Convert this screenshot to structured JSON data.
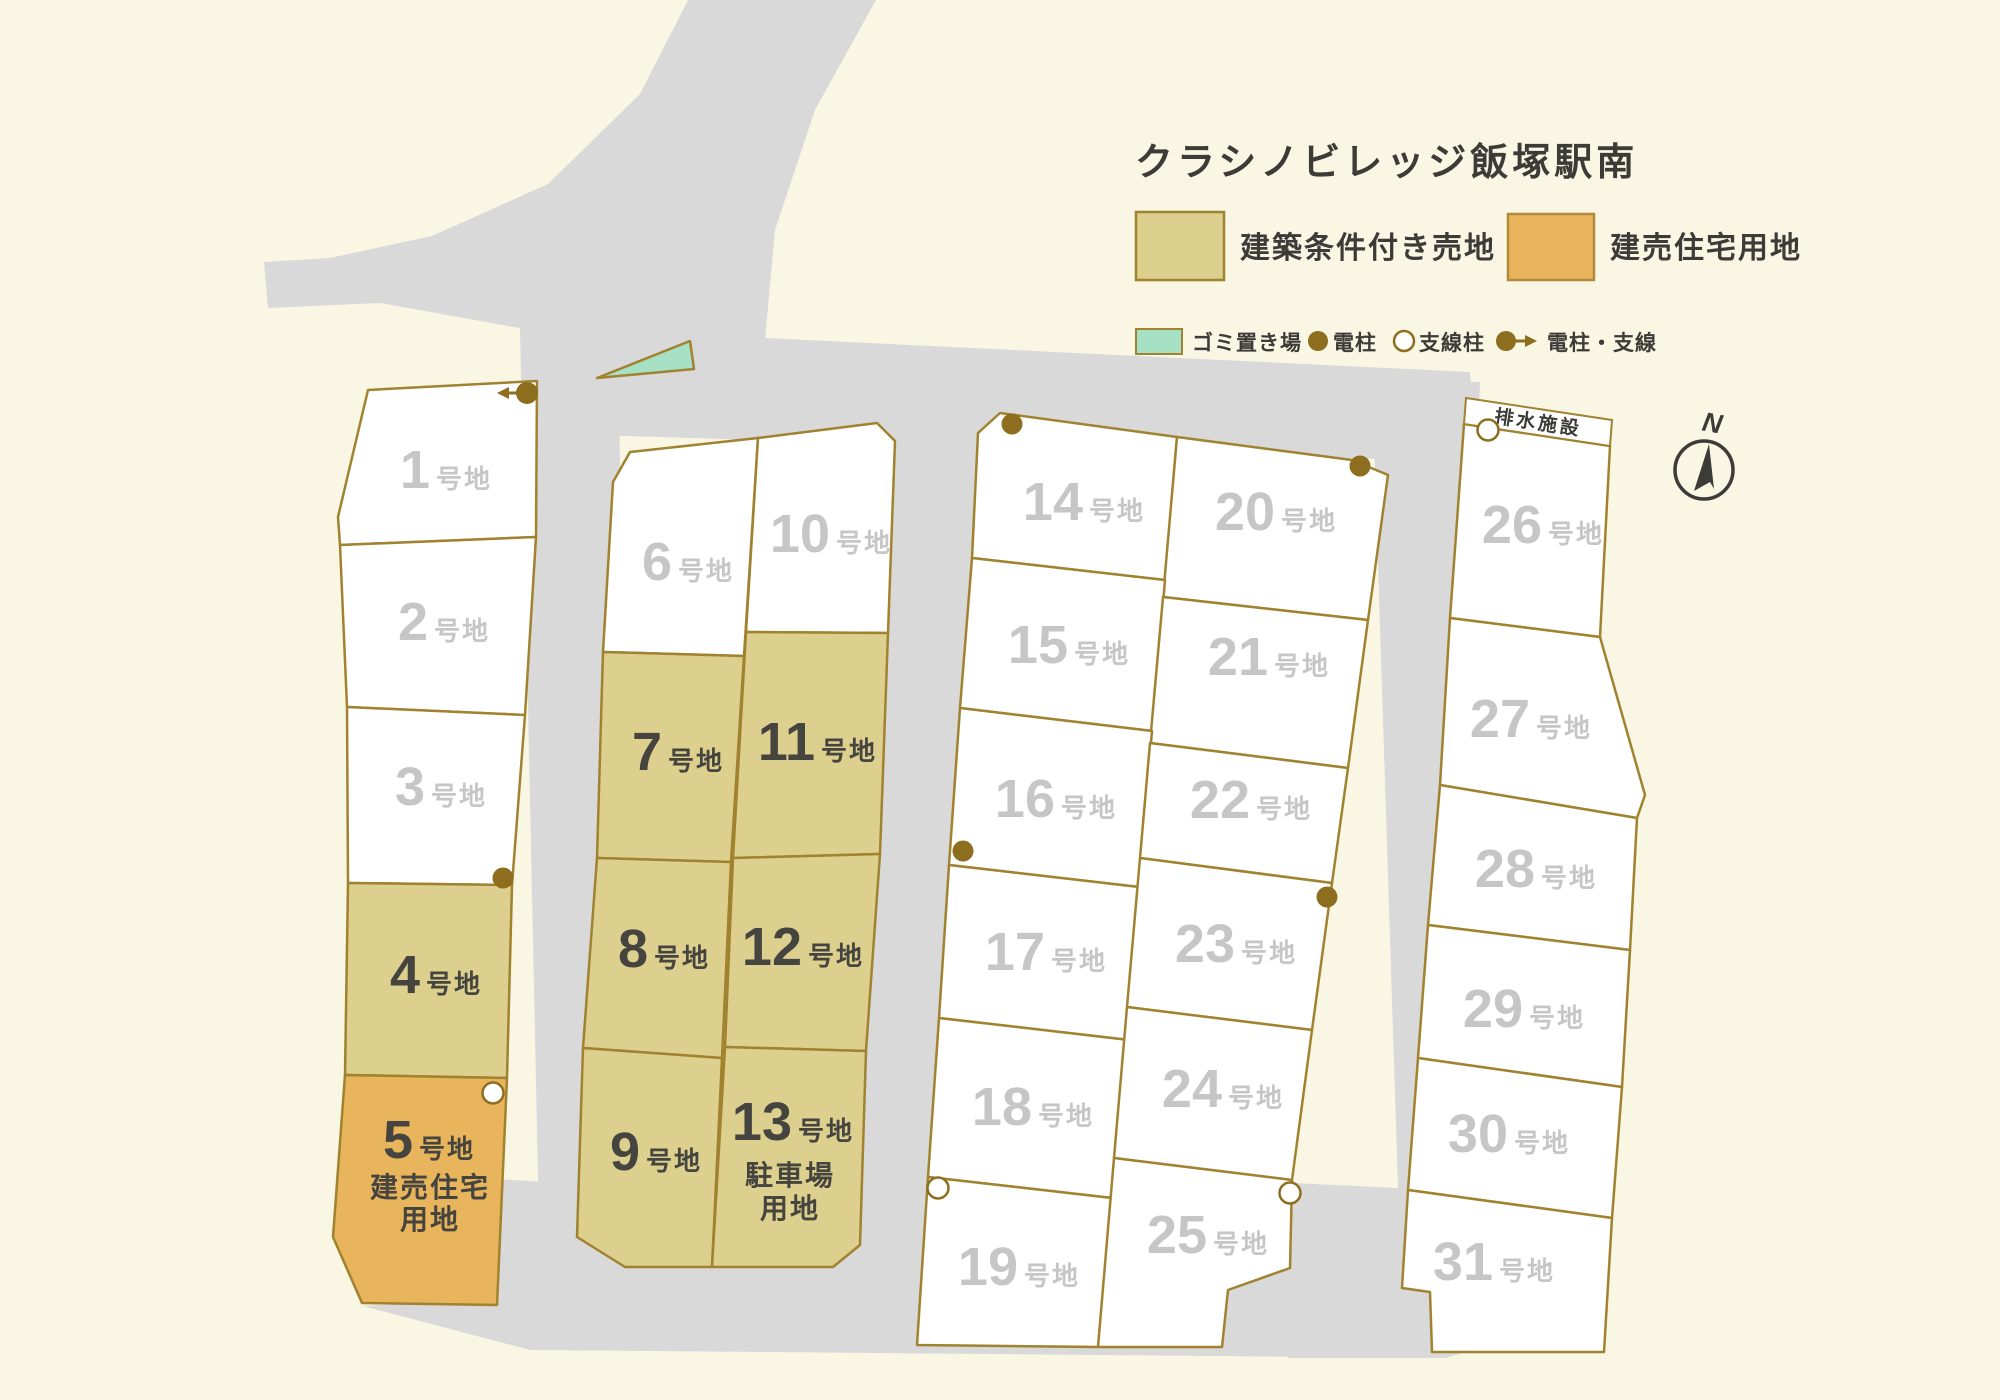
{
  "title": "クラシノビレッジ飯塚駅南",
  "legend": {
    "items": [
      {
        "label": "建築条件付き売地",
        "color": "#ddd08f"
      },
      {
        "label": "建売住宅用地",
        "color": "#e8b55c"
      }
    ],
    "markers": [
      {
        "label": "ゴミ置き場",
        "color": "#a6e1c6"
      },
      {
        "label": "電柱",
        "color": "#8d6e1f"
      },
      {
        "label": "支線柱",
        "color": "#ffffff"
      },
      {
        "label": "電柱・支線",
        "color": "#8d6e1f"
      }
    ]
  },
  "compass": {
    "north_label": "N"
  },
  "annotations": {
    "drainage": "排水施設"
  },
  "colors": {
    "background": "#faf6e4",
    "road": "#d9d9da",
    "border": "#a0822f",
    "pole": "#8d6e1f",
    "label_gray": "#c6c6c6",
    "label_dark": "#45443f"
  },
  "lots": {
    "1": {
      "number": "1",
      "suffix": "号地",
      "color": "#ffffff"
    },
    "2": {
      "number": "2",
      "suffix": "号地",
      "color": "#ffffff"
    },
    "3": {
      "number": "3",
      "suffix": "号地",
      "color": "#ffffff"
    },
    "4": {
      "number": "4",
      "suffix": "号地",
      "color": "#ddd08f"
    },
    "5": {
      "number": "5",
      "suffix": "号地",
      "color": "#e8b55c",
      "sub1": "建売住宅",
      "sub2": "用地"
    },
    "6": {
      "number": "6",
      "suffix": "号地",
      "color": "#ffffff"
    },
    "7": {
      "number": "7",
      "suffix": "号地",
      "color": "#ddd08f"
    },
    "8": {
      "number": "8",
      "suffix": "号地",
      "color": "#ddd08f"
    },
    "9": {
      "number": "9",
      "suffix": "号地",
      "color": "#ddd08f"
    },
    "10": {
      "number": "10",
      "suffix": "号地",
      "color": "#ffffff"
    },
    "11": {
      "number": "11",
      "suffix": "号地",
      "color": "#ddd08f"
    },
    "12": {
      "number": "12",
      "suffix": "号地",
      "color": "#ddd08f"
    },
    "13": {
      "number": "13",
      "suffix": "号地",
      "color": "#ddd08f",
      "sub1": "駐車場",
      "sub2": "用地"
    },
    "14": {
      "number": "14",
      "suffix": "号地",
      "color": "#ffffff"
    },
    "15": {
      "number": "15",
      "suffix": "号地",
      "color": "#ffffff"
    },
    "16": {
      "number": "16",
      "suffix": "号地",
      "color": "#ffffff"
    },
    "17": {
      "number": "17",
      "suffix": "号地",
      "color": "#ffffff"
    },
    "18": {
      "number": "18",
      "suffix": "号地",
      "color": "#ffffff"
    },
    "19": {
      "number": "19",
      "suffix": "号地",
      "color": "#ffffff"
    },
    "20": {
      "number": "20",
      "suffix": "号地",
      "color": "#ffffff"
    },
    "21": {
      "number": "21",
      "suffix": "号地",
      "color": "#ffffff"
    },
    "22": {
      "number": "22",
      "suffix": "号地",
      "color": "#ffffff"
    },
    "23": {
      "number": "23",
      "suffix": "号地",
      "color": "#ffffff"
    },
    "24": {
      "number": "24",
      "suffix": "号地",
      "color": "#ffffff"
    },
    "25": {
      "number": "25",
      "suffix": "号地",
      "color": "#ffffff"
    },
    "26": {
      "number": "26",
      "suffix": "号地",
      "color": "#ffffff"
    },
    "27": {
      "number": "27",
      "suffix": "号地",
      "color": "#ffffff"
    },
    "28": {
      "number": "28",
      "suffix": "号地",
      "color": "#ffffff"
    },
    "29": {
      "number": "29",
      "suffix": "号地",
      "color": "#ffffff"
    },
    "30": {
      "number": "30",
      "suffix": "号地",
      "color": "#ffffff"
    },
    "31": {
      "number": "31",
      "suffix": "号地",
      "color": "#ffffff"
    }
  }
}
